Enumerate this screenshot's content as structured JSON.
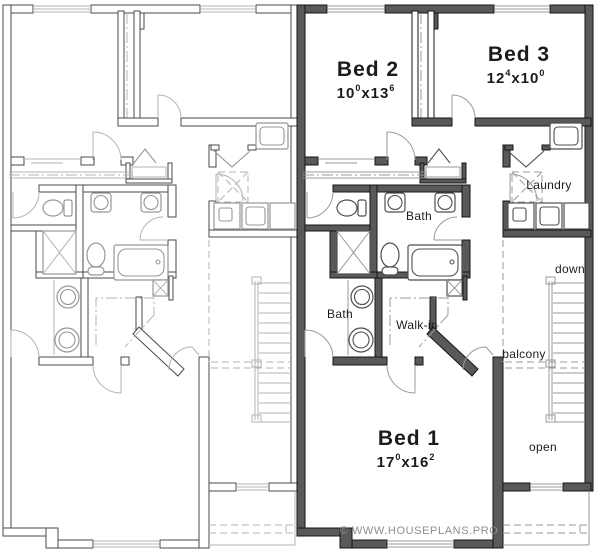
{
  "plan": {
    "type": "duplex-upper-floor-plan",
    "units": {
      "left": {
        "description": "unlabeled mirror unit drawn in light lines"
      },
      "right": {
        "description": "labeled unit drawn in dark lines"
      }
    }
  },
  "labels": {
    "bed1": {
      "name": "Bed 1",
      "ft_a": "17",
      "in_a": "0",
      "times": "x",
      "ft_b": "16",
      "in_b": "2"
    },
    "bed2": {
      "name": "Bed 2",
      "ft_a": "10",
      "in_a": "0",
      "times": "x",
      "ft_b": "13",
      "in_b": "6"
    },
    "bed3": {
      "name": "Bed 3",
      "ft_a": "12",
      "in_a": "4",
      "times": "x",
      "ft_b": "10",
      "in_b": "0"
    },
    "bath_upper": "Bath",
    "bath_master": "Bath",
    "walk_in": "Walk-in",
    "laundry": "Laundry",
    "down": "down",
    "balcony": "balcony",
    "open": "open",
    "watermark": "© WWW.HOUSEPLANS.PRO"
  },
  "colors": {
    "wall_fill": "#58595b",
    "wall_stroke": "#151515",
    "light_unit_stroke": "#4a4a4a",
    "fixture_line": "#4f4f4f",
    "faint_line": "#9a9a9a",
    "label_text": "#1b1b1b",
    "watermark_text": "#8e8e8e"
  }
}
